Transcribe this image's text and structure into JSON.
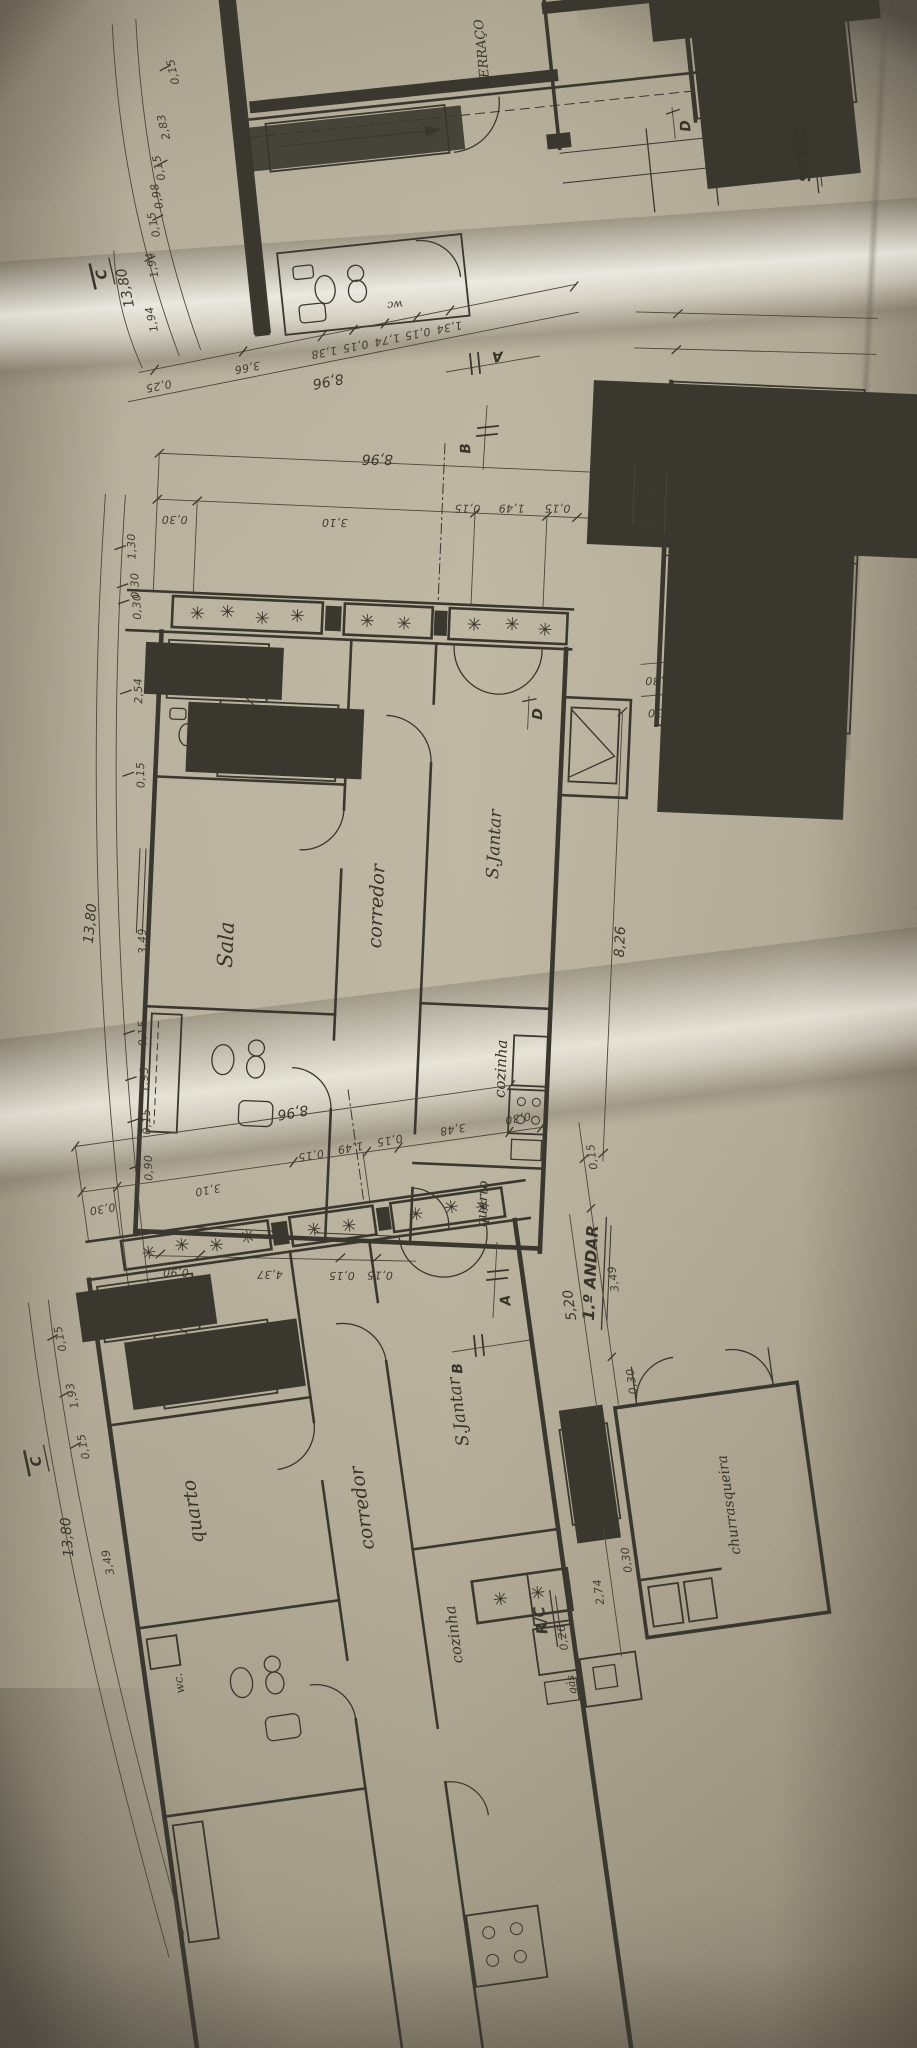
{
  "palette": {
    "paper": "#d9d5c9",
    "ink": "#3a372e",
    "shadow": "#8f8a7c"
  },
  "sotao": {
    "title": "SOTÃO",
    "room_terraco": "TERRAÇO",
    "room_wc": "wc",
    "mark_c": "C",
    "mark_d": "D",
    "mark_a": "A",
    "mark_b": "B",
    "left_total": "13,80",
    "left_chain": [
      "0,15",
      "2,83",
      "0,15",
      "0,98",
      "0,15",
      "1,94",
      "1,94"
    ],
    "bottom_total": "8,96",
    "bottom_chain": [
      "0,25",
      "3,66",
      "1,38",
      "0,15",
      "1,74",
      "0,15",
      "1,34"
    ]
  },
  "andar1": {
    "title": "1.º ANDAR",
    "room_sala": "Sala",
    "room_corredor": "corredor",
    "room_sjantar": "S.Jantar",
    "room_cozinha": "cozinha",
    "room_quarto": "quarto",
    "mark_a": "A",
    "mark_b": "B",
    "mark_d": "D",
    "top_total": "8,96",
    "top_chain": [
      "0,30",
      "3,10",
      "0,15",
      "1,49",
      "0,15"
    ],
    "deck_dims": [
      "0,30",
      "0,30"
    ],
    "fire_dims": [
      "0,30",
      "0,30"
    ],
    "left_total": "13,80",
    "left_chain": [
      "1,30",
      "0,30",
      "0,30",
      "2,54",
      "0,15",
      "3,49",
      "0,15",
      "1,93",
      "0,15",
      "0,90"
    ],
    "dim_826": "8,26",
    "bottom_chain": [
      "0,90",
      "4,37",
      "0,15",
      "0,15"
    ]
  },
  "rc": {
    "title": "R/C",
    "room_quarto": "quarto",
    "room_corredor": "corredor",
    "room_sjantar": "S.Jantar",
    "room_cozinha": "cozinha",
    "room_wc": "wc.",
    "room_churrasqueira": "churrasqueira",
    "label_gas": "gás",
    "mark_a": "A",
    "mark_b": "B",
    "mark_c": "C",
    "top_total": "8,96",
    "top_chain": [
      "0,30",
      "3,10",
      "0,15",
      "1,49",
      "0,15",
      "3,48",
      "0,30"
    ],
    "left_total": "13,80",
    "left_chain": [
      "0,15",
      "1,93",
      "0,15",
      "3,49"
    ],
    "annex_chain": [
      "0,15",
      "3,49",
      "0,30"
    ],
    "dim_520": "5,20",
    "dim_274": "2,74",
    "dim_026": "0,26",
    "dim_030": "0,30"
  }
}
